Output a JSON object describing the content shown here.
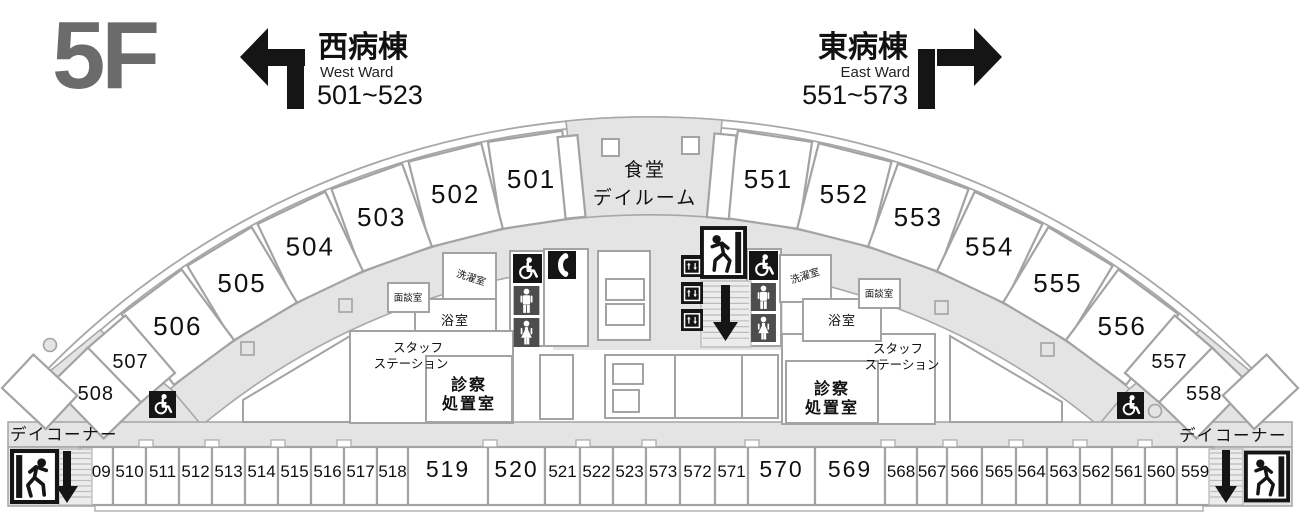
{
  "floor_label": "5F",
  "signs": {
    "west": {
      "title": "西病棟",
      "subtitle": "West Ward",
      "rooms": "501~523",
      "direction": "left"
    },
    "east": {
      "title": "東病棟",
      "subtitle": "East Ward",
      "rooms": "551~573",
      "direction": "right"
    }
  },
  "dining_room": {
    "line1": "食堂",
    "line2": "デイルーム"
  },
  "rooms": {
    "arc_west": [
      "501",
      "502",
      "503",
      "504",
      "505",
      "506",
      "507",
      "508"
    ],
    "arc_east": [
      "551",
      "552",
      "553",
      "554",
      "555",
      "556",
      "557",
      "558"
    ],
    "bottom": [
      "509",
      "510",
      "511",
      "512",
      "513",
      "514",
      "515",
      "516",
      "517",
      "518",
      "519",
      "520",
      "521",
      "522",
      "523",
      "573",
      "572",
      "571",
      "570",
      "569",
      "568",
      "567",
      "566",
      "565",
      "564",
      "563",
      "562",
      "561",
      "560",
      "559"
    ]
  },
  "facilities": {
    "staff_station": {
      "line1": "スタッフ",
      "line2": "ステーション"
    },
    "exam_room": {
      "line1": "診察",
      "line2": "処置室"
    },
    "bath": "浴室",
    "laundry": "洗濯室",
    "meeting": "面談室",
    "day_corner": "デイコーナー"
  },
  "icons": {
    "wheelchair": "wheelchair-accessible",
    "phone": "public-telephone",
    "elevator": "elevator",
    "exit": "emergency-exit",
    "stairs_down": "stairs-down-arrow",
    "toilet_male": "mens-toilet",
    "toilet_female": "womens-toilet"
  },
  "colors": {
    "floor_gray": "#e4e4e4",
    "wall_gray": "#a3a3a3",
    "icon_black": "#151515",
    "icon_dark_gray": "#4d4d4d",
    "floor_label_gray": "#6b6b6b",
    "text_black": "#111111"
  }
}
